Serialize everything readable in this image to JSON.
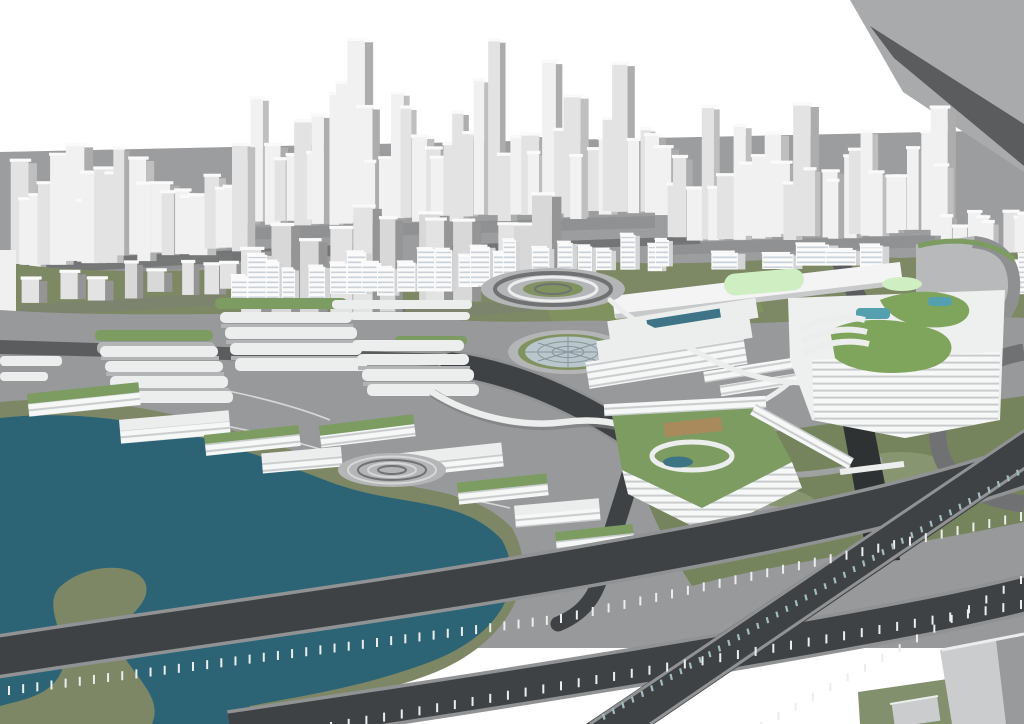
{
  "meta": {
    "kind": "3d-architectural-masterplan-render",
    "features": [
      "background city towers",
      "mid-rise residential band",
      "green-roof campus buildings",
      "glass dome",
      "teal lake",
      "elevated highways on piers"
    ]
  },
  "palette": {
    "sky": "#ffffff",
    "bgGround": "#9c9d9e",
    "bgSlope": "#a9aaab",
    "bgRoad": "#727475",
    "bgRoadDark": "#5a5c5d",
    "towerFace": "#f1f1f1",
    "towerFaceAlt": "#e3e3e3",
    "towerFaceDark": "#d8d8d8",
    "towerSide": "#bfbfbf",
    "towerSideAlt": "#adadad",
    "towerSideDark": "#959595",
    "towerTop": "#fafafa",
    "shadowGray": "#7d7e7f",
    "resFace": "#fbfbfb",
    "resSide": "#d2d4d5",
    "resWindow": "#aab8c2",
    "midGreen": "#7d8865",
    "lawnGreen": "#80925f",
    "roofGreen": "#7c9c62",
    "brightRoof": "#7fa45c",
    "mintRoof": "#cfeec2",
    "campusGray": "#98999b",
    "plazaLight": "#b4b5b6",
    "pathWhite": "#eceded",
    "contourWhite": "#d6d7d7",
    "slabShadow": "#b2b4b5",
    "oliveShore": "#7d8765",
    "lake": "#2c6476",
    "poolTeal": "#55a0af",
    "canalDark": "#2f3233",
    "roadDark": "#3f4244",
    "roadEdge": "#909294",
    "roadMid": "#6f7172",
    "pierWhite": "#eceded",
    "railTeal": "#a3bcc0",
    "domeGlass": "#b9c6cc",
    "domeLine": "#87949c",
    "skylightTeal": "#3f7488",
    "amberDeck": "#a88a5c",
    "cornerBoxFace": "#cbcccd",
    "cornerBoxSide": "#999a9b",
    "parkGreen": "#76845e",
    "parkGreenLight": "#879570",
    "parkPath": "#a0a2a1",
    "darkGreen": "#6d7a57"
  },
  "generators": {
    "seed": 13,
    "tower_clusters": [
      {
        "name": "far-center",
        "layer": "far",
        "x0": 235,
        "x1": 655,
        "base0": 225,
        "base1": 213,
        "hMin": 60,
        "hMax": 200,
        "wMin": 14,
        "wMax": 27,
        "n": 40
      },
      {
        "name": "far-right",
        "layer": "far",
        "x0": 660,
        "x1": 935,
        "base0": 240,
        "base1": 232,
        "hMin": 50,
        "hMax": 170,
        "wMin": 15,
        "wMax": 27,
        "n": 26
      },
      {
        "name": "far-left",
        "layer": "far",
        "x0": 4,
        "x1": 232,
        "base0": 268,
        "base1": 250,
        "hMin": 55,
        "hMax": 128,
        "wMin": 16,
        "wMax": 30,
        "n": 22
      },
      {
        "name": "edge-right",
        "layer": "far",
        "x0": 935,
        "x1": 1018,
        "base0": 262,
        "base1": 254,
        "hMin": 35,
        "hMax": 85,
        "wMin": 14,
        "wMax": 24,
        "n": 8
      },
      {
        "name": "low-left",
        "layer": "near",
        "x0": 20,
        "x1": 220,
        "base0": 302,
        "base1": 290,
        "hMin": 18,
        "hMax": 40,
        "wMin": 16,
        "wMax": 26,
        "n": 8,
        "dark": true
      },
      {
        "name": "mid-gray",
        "layer": "near",
        "x0": 238,
        "x1": 532,
        "base0": 322,
        "base1": 296,
        "hMin": 70,
        "hMax": 115,
        "wMin": 20,
        "wMax": 34,
        "n": 12,
        "dark": true
      }
    ],
    "residential_rows": [
      {
        "x0": 225,
        "x1": 470,
        "base0": 302,
        "base1": 288,
        "hMin": 26,
        "hMax": 46,
        "wMin": 13,
        "wMax": 20,
        "n": 14
      },
      {
        "x0": 480,
        "x1": 655,
        "base0": 282,
        "base1": 268,
        "hMin": 20,
        "hMax": 38,
        "wMin": 12,
        "wMax": 18,
        "n": 9
      },
      {
        "x0": 700,
        "x1": 860,
        "base0": 272,
        "base1": 266,
        "hMin": 14,
        "hMax": 24,
        "wMin": 22,
        "wMax": 34,
        "n": 5
      },
      {
        "x0": 950,
        "x1": 1018,
        "base0": 300,
        "base1": 292,
        "hMin": 20,
        "hMax": 40,
        "wMin": 12,
        "wMax": 18,
        "n": 5
      }
    ],
    "pier_rows": [
      {
        "x0": 8,
        "y0": 686,
        "x1": 560,
        "y1": 614,
        "n": 40,
        "len": 9
      },
      {
        "x0": 560,
        "y0": 614,
        "x1": 1020,
        "y1": 512,
        "n": 30,
        "len": 9
      },
      {
        "x0": 330,
        "y0": 722,
        "x1": 1020,
        "y1": 600,
        "n": 40,
        "len": 9
      },
      {
        "x0": 760,
        "y0": 722,
        "x1": 1020,
        "y1": 576,
        "n": 16,
        "len": 8
      }
    ],
    "rail_rows": [
      {
        "x0": 602,
        "y0": 714,
        "x1": 1016,
        "y1": 470,
        "n": 44,
        "len": 6
      }
    ]
  }
}
